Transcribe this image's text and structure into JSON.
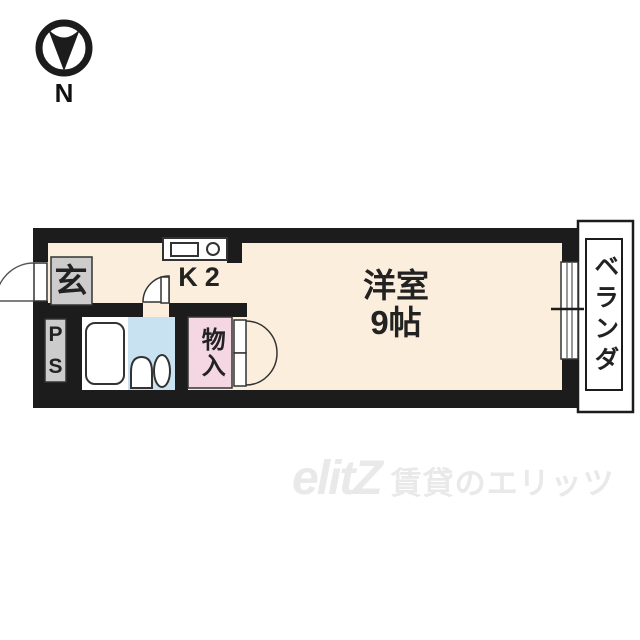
{
  "compass": {
    "north_label": "N"
  },
  "floor_plan": {
    "entrance": {
      "label": "玄"
    },
    "pipe_space": {
      "label_line1": "P",
      "label_line2": "S"
    },
    "kitchen": {
      "label": "K2"
    },
    "western_room": {
      "label_line1": "洋室",
      "label_line2": "9帖"
    },
    "storage": {
      "label": "物入"
    },
    "veranda": {
      "label": "ベランダ"
    }
  },
  "watermark": {
    "logo": "elitZ",
    "text": "賃貸のエリッツ"
  },
  "colors": {
    "wall": "#1c1c1c",
    "floor": "#fbeedd",
    "bath": "#c9e2f2",
    "storage": "#f5d7e4",
    "gray": "#cccccc",
    "line": "#333333",
    "watermark": "#e9e9e9",
    "text": "#222222"
  }
}
